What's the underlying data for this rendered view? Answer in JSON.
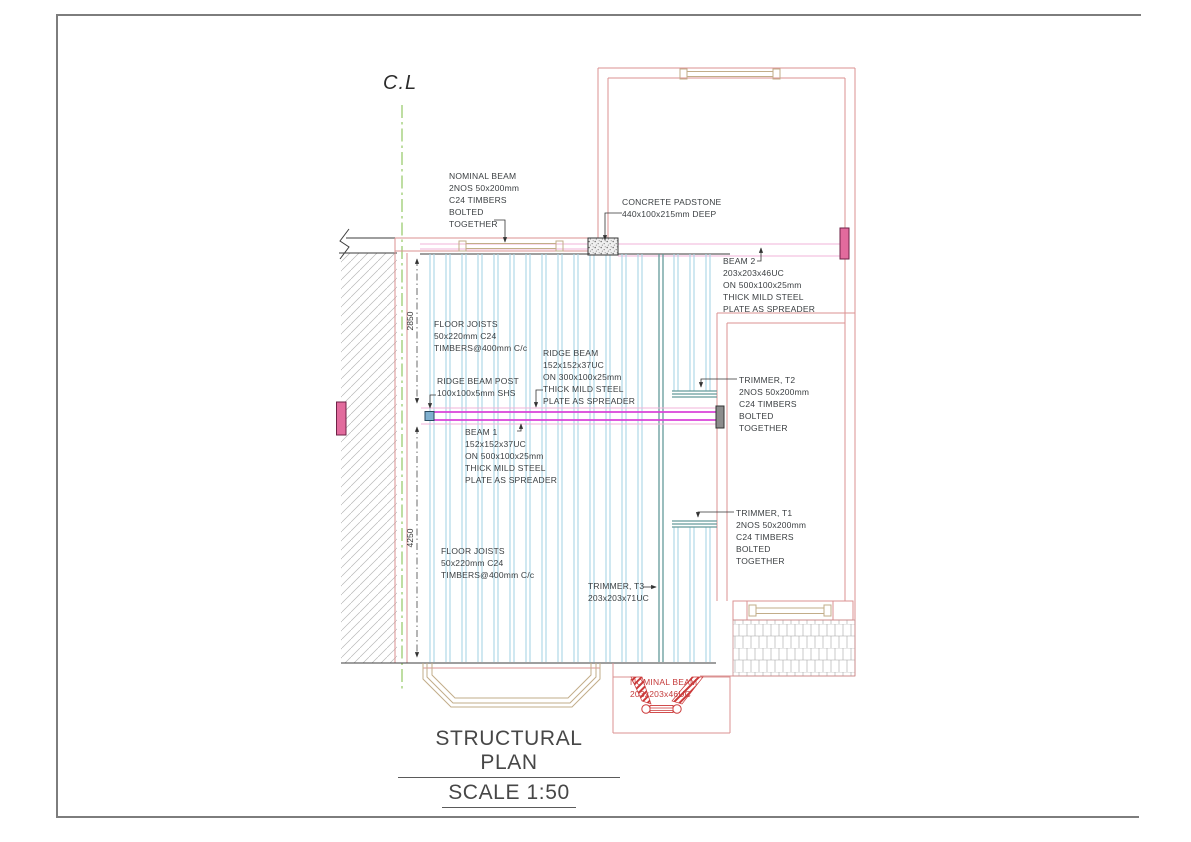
{
  "drawing": {
    "centerline_label": "C.L",
    "title_line1": "STRUCTURAL PLAN",
    "title_line2": "SCALE 1:50",
    "dim_upper": "2850",
    "dim_lower": "4250",
    "labels": {
      "nominal_beam_top": "NOMINAL BEAM\n2NOS 50x200mm\nC24 TIMBERS\nBOLTED\nTOGETHER",
      "concrete_padstone": "CONCRETE PADSTONE\n440x100x215mm DEEP",
      "beam_2": "BEAM 2\n203x203x46UC\nON 500x100x25mm\nTHICK MILD STEEL\nPLATE AS SPREADER",
      "floor_joists_upper": "FLOOR JOISTS\n50x220mm C24\nTIMBERS@400mm C/c",
      "ridge_beam": "RIDGE BEAM\n152x152x37UC\nON 300x100x25mm\nTHICK MILD STEEL\nPLATE AS SPREADER",
      "ridge_beam_post": "RIDGE BEAM POST\n100x100x5mm SHS",
      "beam_1": "BEAM 1\n152x152x37UC\nON 500x100x25mm\nTHICK MILD STEEL\nPLATE AS SPREADER",
      "trimmer_t2": "TRIMMER, T2\n2NOS 50x200mm\nC24 TIMBERS\nBOLTED\nTOGETHER",
      "trimmer_t1": "TRIMMER, T1\n2NOS 50x200mm\nC24 TIMBERS\nBOLTED\nTOGETHER",
      "trimmer_t3": "TRIMMER, T3\n203x203x71UC",
      "floor_joists_lower": "FLOOR JOISTS\n50x220mm C24\nTIMBERS@400mm C/c",
      "nominal_beam_bottom": "NOMINAL BEAM\n203x203x46UC"
    },
    "colors": {
      "wall-red": "#db9292",
      "wall-red-strong": "#c84040",
      "joist-blue": "#a8d5e5",
      "trimmer-teal": "#639a9a",
      "beam-magenta": "#d943d9",
      "beam-pink-light": "#f1b3d9",
      "bearing-pink": "#e26b9d",
      "lintel-tan": "#c2ad89",
      "centerline-green": "#a3cf7a",
      "hatch-gray": "#b6b6b6",
      "line-black": "#3d3d3d",
      "brick-gray": "#a5a5a5"
    }
  }
}
